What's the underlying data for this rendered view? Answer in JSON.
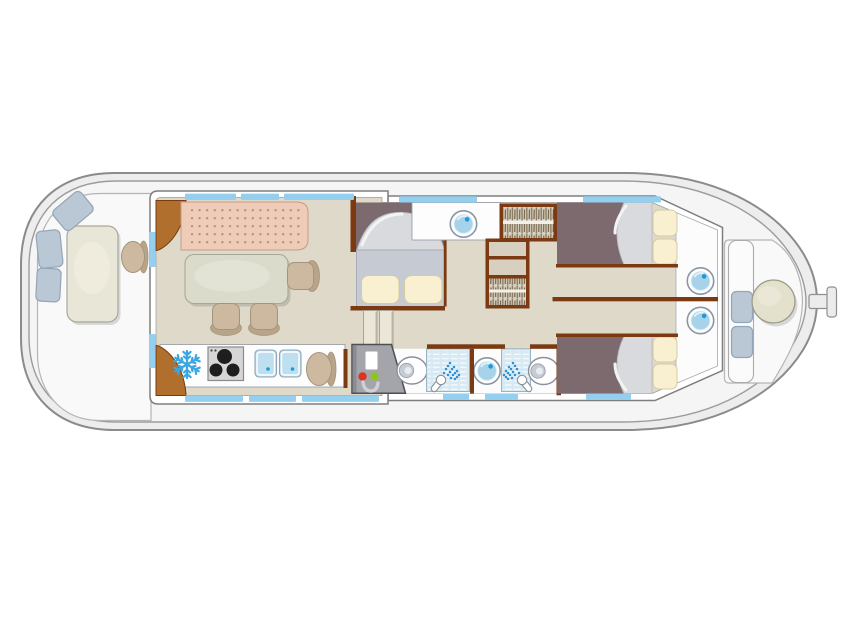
{
  "canvas": {
    "width": 844,
    "height": 635,
    "background": "#ffffff"
  },
  "diagram": {
    "type": "boat-floor-plan",
    "view": "top-down",
    "orientation": "bow-left-stern-right-with-tiller"
  },
  "colors": {
    "hull-fill": "#ededed",
    "hull-stroke": "#8b8b8b",
    "hull-inner-fill": "#f5f5f5",
    "hull-inner-stroke": "#9c9c9c",
    "cockpit-fill": "#f9f9f9",
    "cockpit-stroke": "#b5b5b5",
    "wall-fill": "#ffffff",
    "wall-stroke": "#7e7e7e",
    "floor-beige": "#ded9c8",
    "floor-plum": "#7c6a6e",
    "wood-dark": "#7b3a12",
    "wood-mid": "#b06f2c",
    "window-blue": "#94cff0",
    "cushion-fill": "#bac7d5",
    "cushion-stroke": "#93a5b8",
    "table-cream": "#e8e6d6",
    "table-stroke": "#a8a89a",
    "salon-table": "#dbdbcc",
    "sofa-fill": "#eeccb8",
    "sofa-stroke": "#c49d87",
    "sofa-dot": "#b5907a",
    "chair-tan": "#ccb99f",
    "chair-dark": "#b7a489",
    "chair-stroke": "#a5947c",
    "mattress": "#c6cad3",
    "mattress-stroke": "#a6acb8",
    "duvet": "#d8dade",
    "pillow": "#f8f0d0",
    "pillow-stroke": "#d5cba2",
    "counter-stroke": "#9aa0a8",
    "basin-ring": "#8a96a4",
    "basin-water": "#a7d3ea",
    "basin-dot": "#1f97d8",
    "shower-tile": "#d7e9f3",
    "shower-stroke": "#9ab4c4",
    "spray": "#2e8fd0",
    "sink-blue": "#bedff0",
    "stove": "#d6d6d6",
    "burner": "#1e1e1e",
    "snowflake": "#3ba7e0",
    "wardrobe-tan": "#d7d0c0",
    "clothes": "#6b5b43",
    "graybox": "#a4a5ab",
    "graybox-stroke": "#4e4f54",
    "box-red": "#df3220",
    "box-green": "#8fc321",
    "box-u": "#cfd0d4",
    "toilet-bowl": "#c6cbd4",
    "seat-round": "#e3e0cb"
  },
  "areas": [
    {
      "name": "bow-deck",
      "fixtures": [
        "outdoor-table",
        "seat-cushion",
        "seat-cushion",
        "seat-cushion",
        "skipper-chair"
      ]
    },
    {
      "name": "salon",
      "fixtures": [
        "corner-cabinet",
        "sofa-bench",
        "dining-table",
        "dining-chair",
        "dining-chair",
        "dining-chair"
      ]
    },
    {
      "name": "galley",
      "fixtures": [
        "refrigerator",
        "stove-3-burners",
        "double-sink",
        "chair",
        "corner-cabinet"
      ]
    },
    {
      "name": "mid-cabin",
      "fixtures": [
        "double-bed",
        "folding-door"
      ]
    },
    {
      "name": "hallway",
      "fixtures": [
        "washbasin-counter",
        "hanging-wardrobe",
        "shelf-unit"
      ]
    },
    {
      "name": "bathroom-forward",
      "fixtures": [
        "water-heater-unit",
        "toilet",
        "shower"
      ]
    },
    {
      "name": "bathroom-aft",
      "fixtures": [
        "washbasin",
        "shower",
        "toilet"
      ]
    },
    {
      "name": "aft-cabin-port",
      "fixtures": [
        "double-bed",
        "washbasin"
      ]
    },
    {
      "name": "aft-cabin-starboard",
      "fixtures": [
        "double-bed",
        "washbasin"
      ]
    },
    {
      "name": "stern-deck",
      "fixtures": [
        "bench-cushion",
        "bench-cushion",
        "helm-seat",
        "tiller"
      ]
    }
  ]
}
